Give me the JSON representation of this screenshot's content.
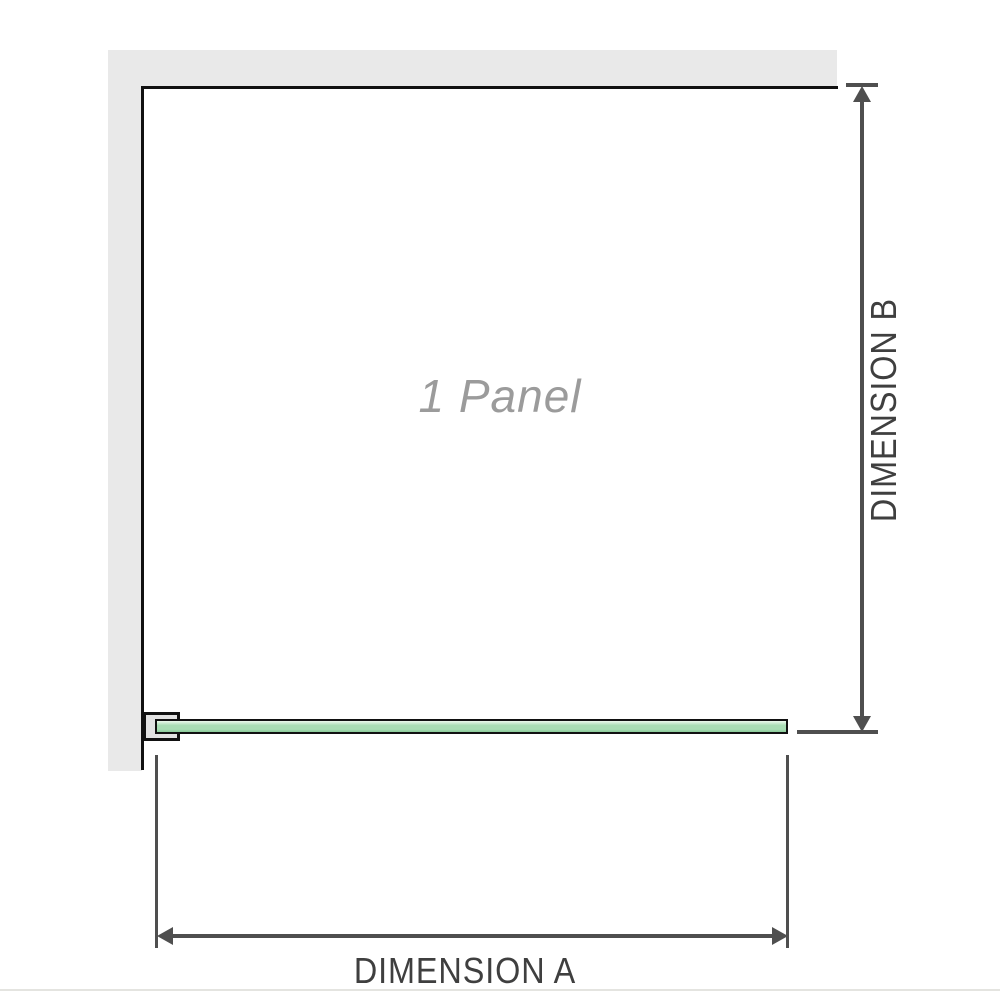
{
  "diagram": {
    "panel_label": "1 Panel",
    "dimension_a": {
      "label": "DIMENSION A"
    },
    "dimension_b": {
      "label": "DIMENSION B"
    },
    "colors": {
      "wall": "#e9e9e9",
      "wall_edge": "#111111",
      "bracket_fill": "#e2e2e2",
      "glass_light": "#eef9ee",
      "glass_mid": "#a9ddb4",
      "glass_dark": "#8acb9a",
      "arrow": "#4f4f4f",
      "text_dark": "#3f3f3f",
      "text_gray": "#9b9b9b",
      "divider": "#e4e4e0"
    }
  }
}
